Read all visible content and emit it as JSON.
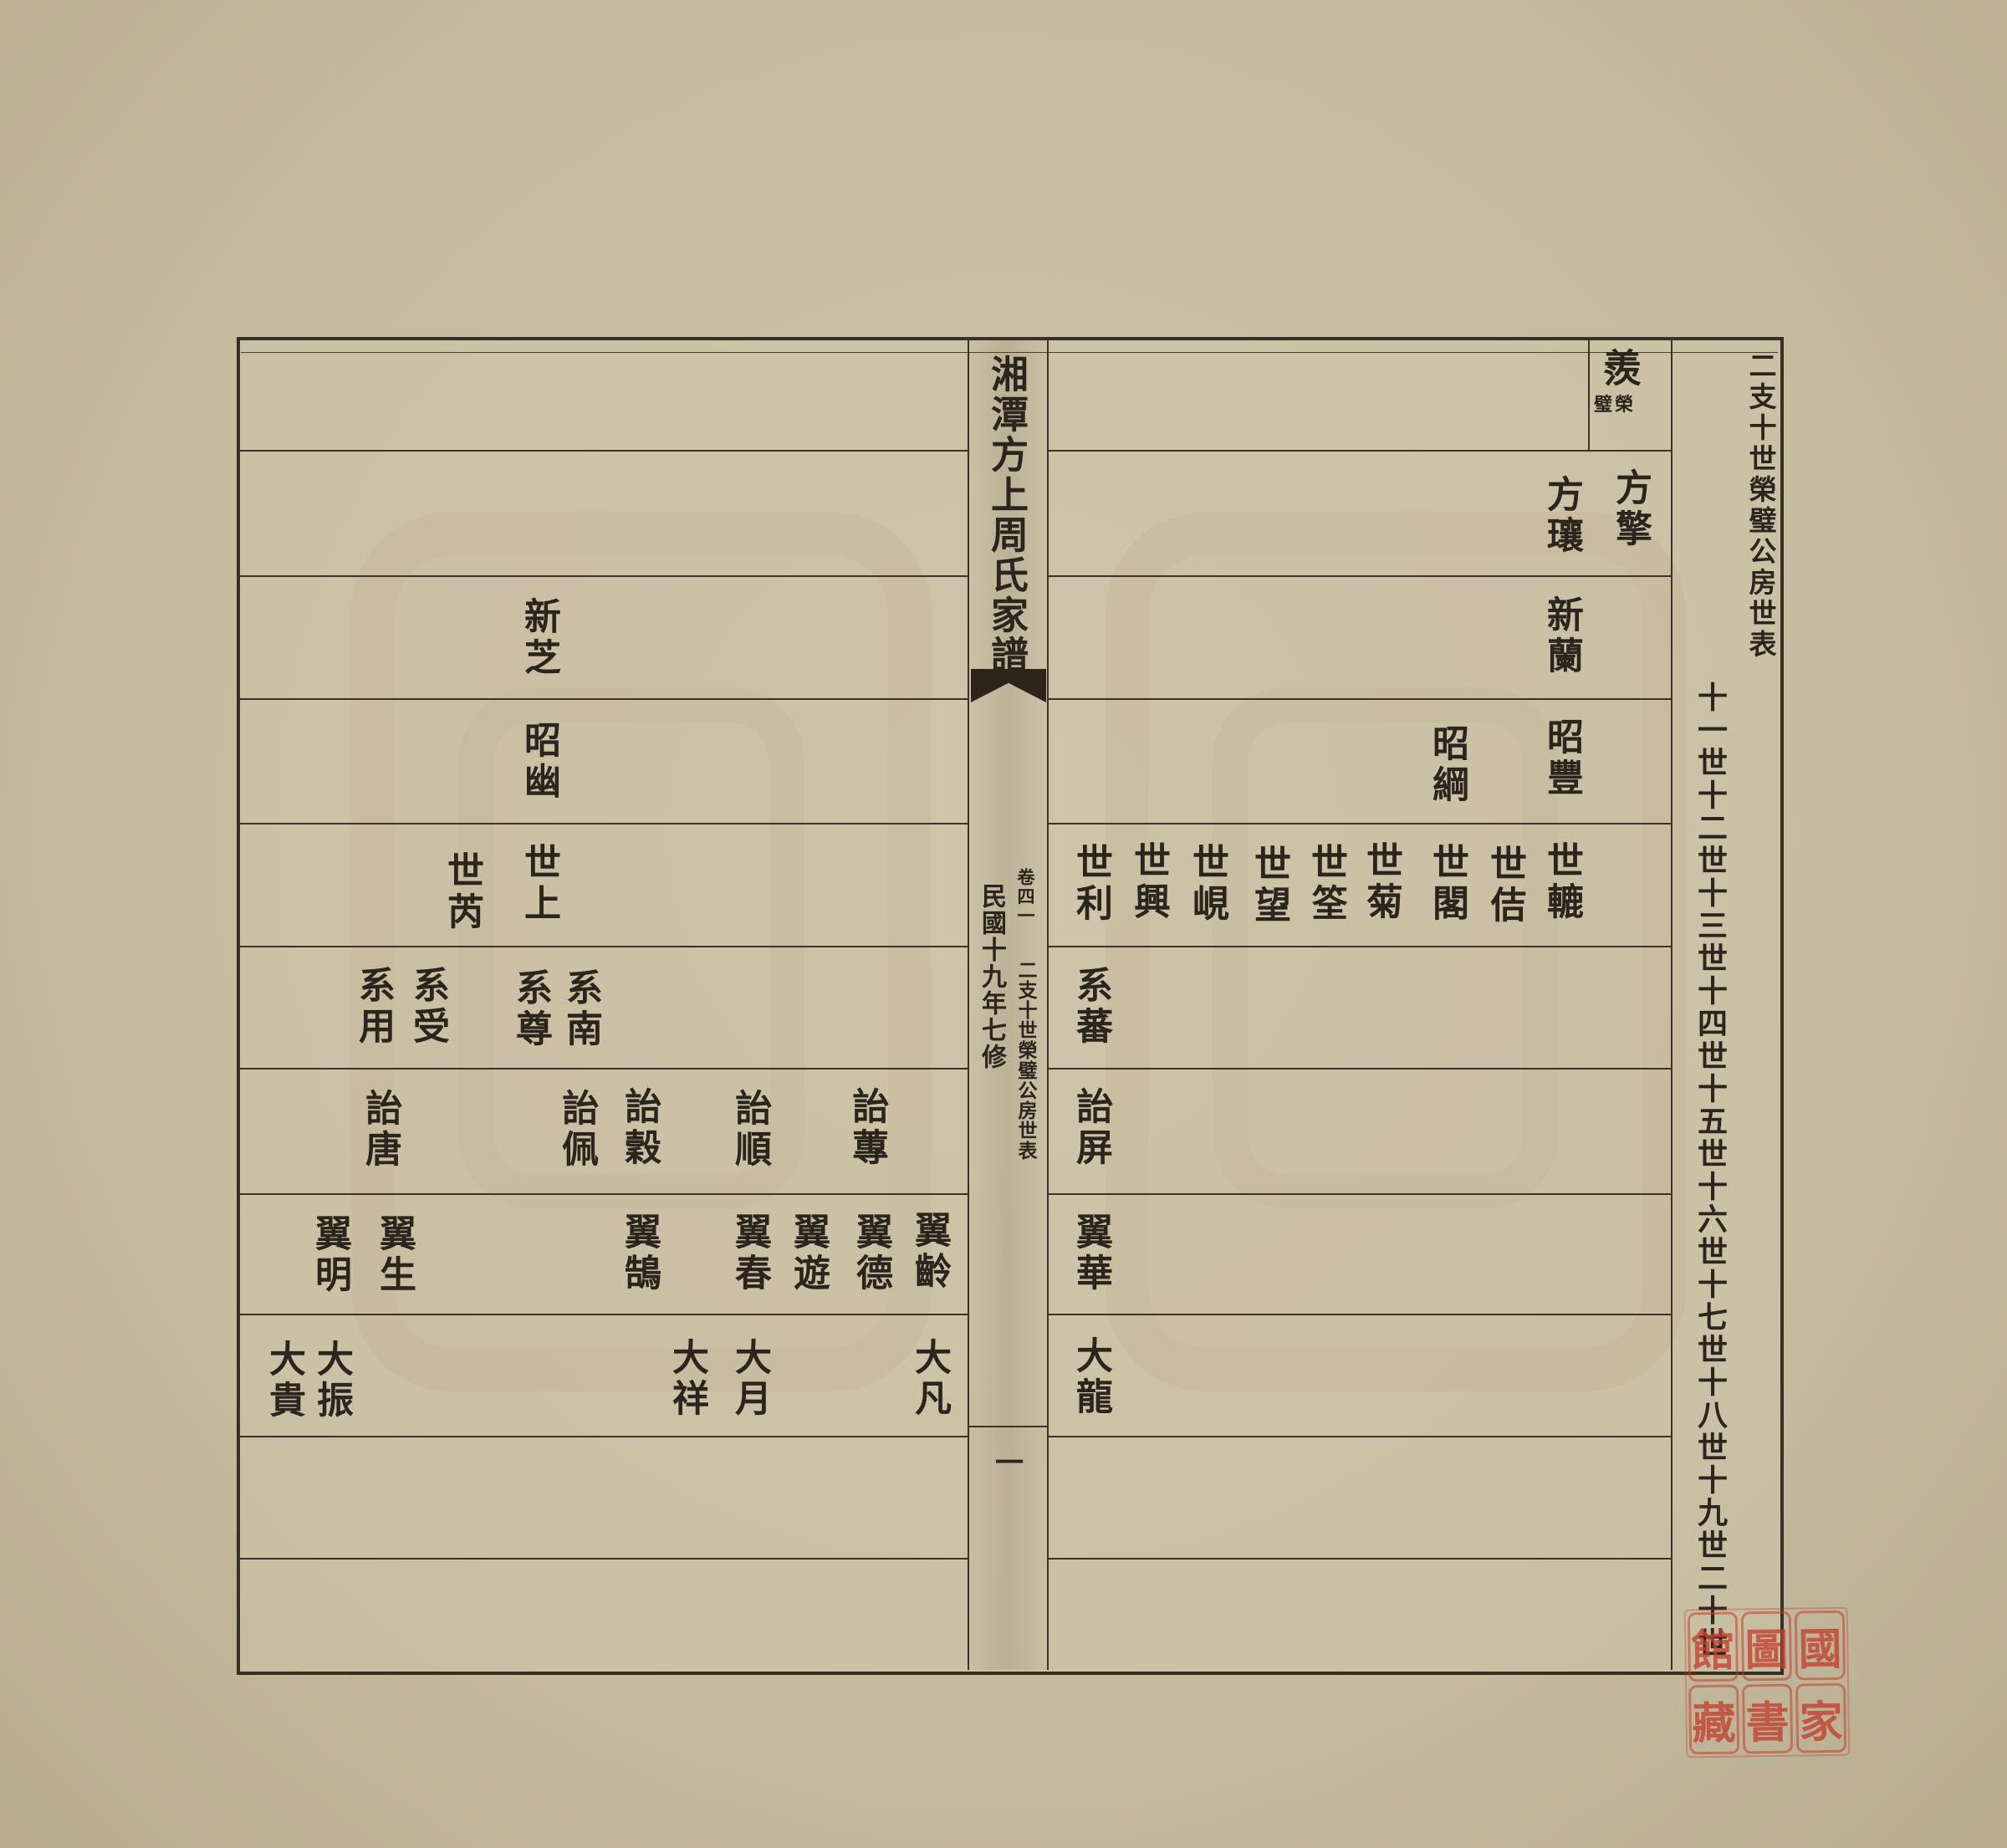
{
  "palette": {
    "paper": "#c6bca0",
    "page": "#cdc4a9",
    "line": "#3b3327",
    "ink": "#2b251d",
    "seal_red": "#c13f2e"
  },
  "header_column": {
    "table_title": "二支十世榮璧公房世表",
    "generation_scale": "十一世十二世十三世十四世十五世十六世十七世十八世十九世二十世"
  },
  "spine": {
    "book_title": "湘潭方上周氏家譜",
    "volume": "卷四一",
    "section_title": "二支十世榮璧公房世表",
    "edition_note": "民國十九年七修",
    "page_number": "一"
  },
  "right_page": {
    "ancestor": {
      "name": "羨",
      "note": "榮璧"
    },
    "generations": {
      "gen11": [
        "方擎",
        "方瓖"
      ],
      "gen12": [
        "新蘭"
      ],
      "gen13": [
        "昭豐",
        "昭綱"
      ],
      "gen14": [
        "世轆",
        "世佶",
        "世閣",
        "世菊",
        "世筌",
        "世望",
        "世峴",
        "世興",
        "世利"
      ],
      "gen15": [
        "系蕃"
      ],
      "gen16": [
        "詒屏"
      ],
      "gen17": [
        "翼華"
      ],
      "gen18": [
        "大龍"
      ]
    }
  },
  "left_page": {
    "generations": {
      "gen12": [
        "新芝"
      ],
      "gen13": [
        "昭幽"
      ],
      "gen14": [
        "世上",
        "世芮"
      ],
      "gen15": [
        "系南",
        "系尊",
        "系受",
        "系用"
      ],
      "gen16": [
        "詒蓴",
        "詒順",
        "詒穀",
        "詒佩",
        "詒唐"
      ],
      "gen17": [
        "翼齡",
        "翼德",
        "翼遊",
        "翼春",
        "翼鵠",
        "翼生",
        "翼明"
      ],
      "gen18": [
        "大凡",
        "大月",
        "大祥",
        "大振",
        "大貴"
      ]
    }
  },
  "seal": {
    "chars": [
      "國",
      "家",
      "圖",
      "書",
      "館",
      "藏"
    ]
  }
}
